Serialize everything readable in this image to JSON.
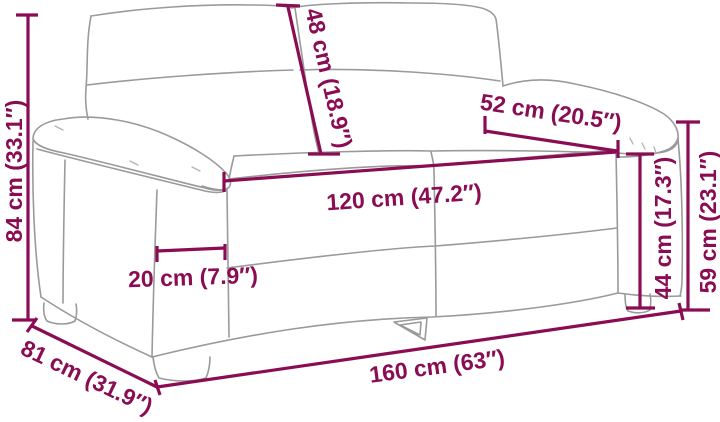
{
  "page": {
    "background_color": "#ffffff"
  },
  "diagram": {
    "subject": "two-seater sofa dimension drawing",
    "accent_color": "#8a0c53",
    "sofa_outline_color": "#9a9a9a",
    "unit_system": "cm / inches",
    "dimensions": {
      "overall_height": {
        "label": "84 cm (33.1″)",
        "cm": 84,
        "inches": 33.1
      },
      "backrest_height": {
        "label": "48 cm (18.9″)",
        "cm": 48,
        "inches": 18.9
      },
      "armrest_length": {
        "label": "52 cm (20.5″)",
        "cm": 52,
        "inches": 20.5
      },
      "seat_width": {
        "label": "120 cm (47.2″)",
        "cm": 120,
        "inches": 47.2
      },
      "armrest_width": {
        "label": "20 cm (7.9″)",
        "cm": 20,
        "inches": 7.9
      },
      "seat_height": {
        "label": "44 cm (17.3″)",
        "cm": 44,
        "inches": 17.3
      },
      "arm_height": {
        "label": "59 cm (23.1″)",
        "cm": 59,
        "inches": 23.1
      },
      "overall_width": {
        "label": "160 cm (63″)",
        "cm": 160,
        "inches": 63
      },
      "overall_depth": {
        "label": "81 cm (31.9″)",
        "cm": 81,
        "inches": 31.9
      }
    }
  }
}
